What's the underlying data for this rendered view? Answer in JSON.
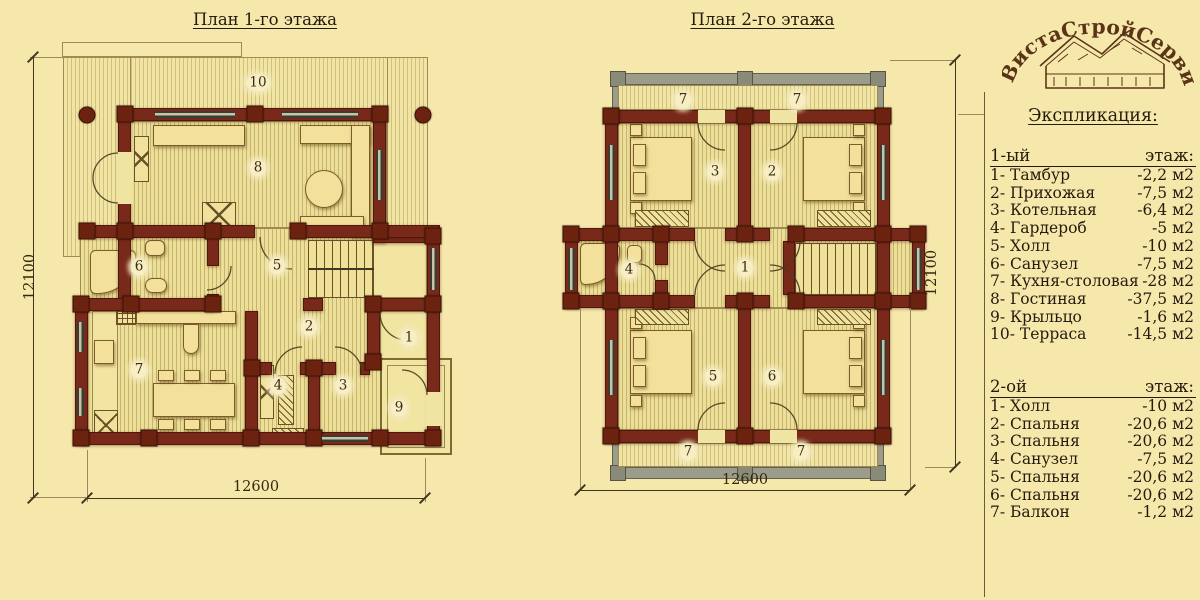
{
  "colors": {
    "background": "#f6e8ab",
    "log_wall": "#78291a",
    "balcony_wall": "#9c9c8a",
    "floor_stripe": "#c8b470",
    "text": "#241a0e",
    "logo_brown": "#5a3417"
  },
  "plan1": {
    "title": "План 1-го этажа",
    "dim_width": "12600",
    "dim_height": "12100",
    "badges": [
      "10",
      "8",
      "6",
      "5",
      "2",
      "1",
      "7",
      "4",
      "3",
      "9"
    ]
  },
  "plan2": {
    "title": "План 2-го этажа",
    "dim_width": "12600",
    "dim_height": "12100",
    "badges": [
      "7",
      "7",
      "3",
      "2",
      "1",
      "4",
      "5",
      "6",
      "7",
      "7"
    ]
  },
  "legend": {
    "title": "Экспликация:",
    "floor1": {
      "header_left": "1-ый",
      "header_right": "этаж:",
      "items": [
        {
          "label": "1- Тамбур",
          "area": "-2,2 м2"
        },
        {
          "label": "2- Прихожая",
          "area": "-7,5 м2"
        },
        {
          "label": "3- Котельная",
          "area": "-6,4 м2"
        },
        {
          "label": "4- Гардероб",
          "area": "-5 м2"
        },
        {
          "label": "5- Холл",
          "area": "-10 м2"
        },
        {
          "label": "6- Санузел",
          "area": "-7,5 м2"
        },
        {
          "label": "7- Кухня-столовая",
          "area": "-28 м2"
        },
        {
          "label": "8- Гостиная",
          "area": "-37,5 м2"
        },
        {
          "label": "9- Крыльцо",
          "area": "-1,6 м2"
        },
        {
          "label": "10- Терраса",
          "area": "-14,5 м2"
        }
      ]
    },
    "floor2": {
      "header_left": "2-ой",
      "header_right": "этаж:",
      "items": [
        {
          "label": "1- Холл",
          "area": "-10 м2"
        },
        {
          "label": "2- Спальня",
          "area": "-20,6 м2"
        },
        {
          "label": "3- Спальня",
          "area": "-20,6 м2"
        },
        {
          "label": "4- Санузел",
          "area": "-7,5 м2"
        },
        {
          "label": "5- Спальня",
          "area": "-20,6 м2"
        },
        {
          "label": "6- Спальня",
          "area": "-20,6 м2"
        },
        {
          "label": "7- Балкон",
          "area": "-1,2 м2"
        }
      ]
    }
  },
  "logo": {
    "text": "ВистаСтройСервис"
  }
}
